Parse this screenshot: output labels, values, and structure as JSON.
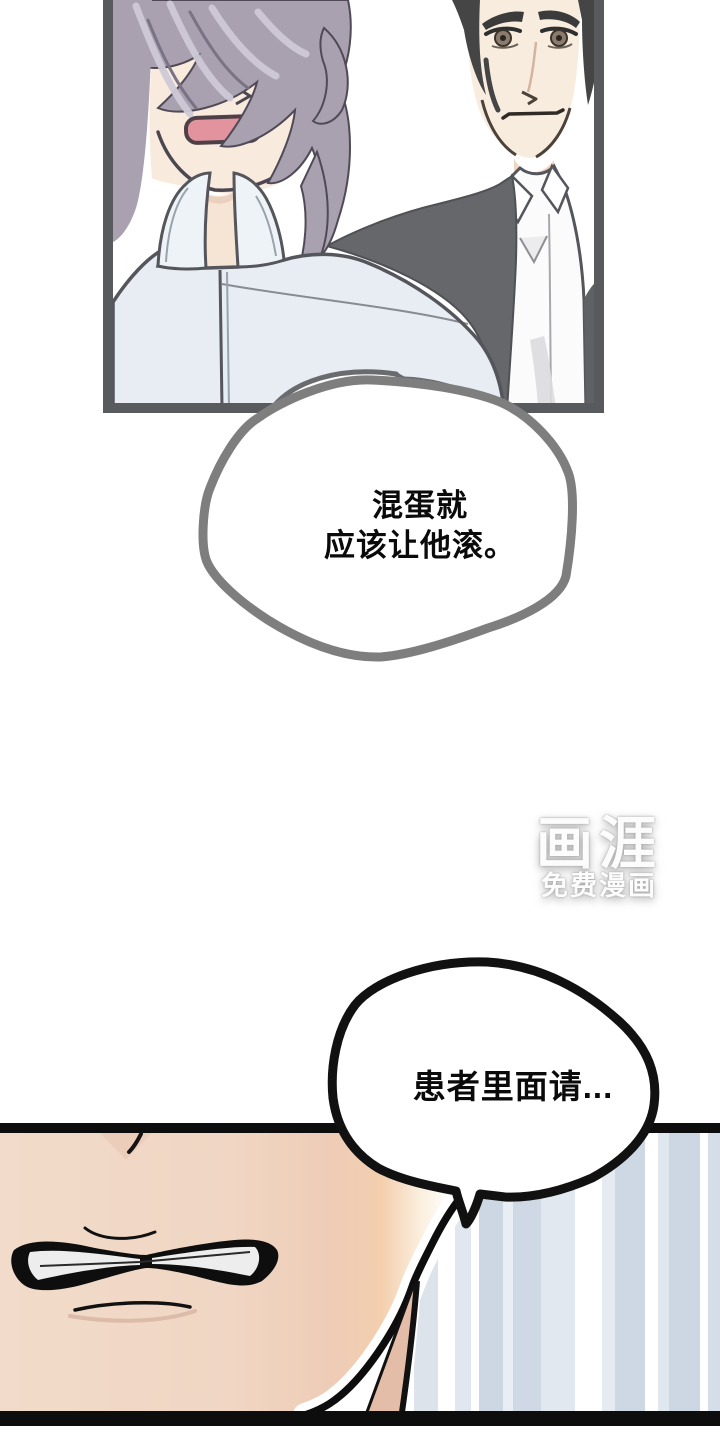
{
  "bubbles": {
    "first": {
      "lines": [
        "混蛋就",
        "应该让他滚。"
      ]
    },
    "second": {
      "lines": [
        "患者里面请..."
      ]
    }
  },
  "watermark": {
    "logo": "画涯",
    "tagline": "免费漫画"
  },
  "colors": {
    "page_bg": "#ffffff",
    "panel_border": "#595a5d",
    "bubble1_stroke": "#7e7e7e",
    "bubble2_stroke": "#111111",
    "ink": "#0d0d0d",
    "hair_left_character": "#a9a1b0",
    "hair_right_character": "#454545",
    "jacket_light_blue": "#e7edf3",
    "jacket_dark_gray": "#66676a",
    "skin_light": "#f8eadd",
    "skin_warm": "#f0d6c3",
    "mouth_pink": "#e2939e",
    "stripe_blue": "#ccd7e3",
    "watermark_color": "#ffffff"
  }
}
